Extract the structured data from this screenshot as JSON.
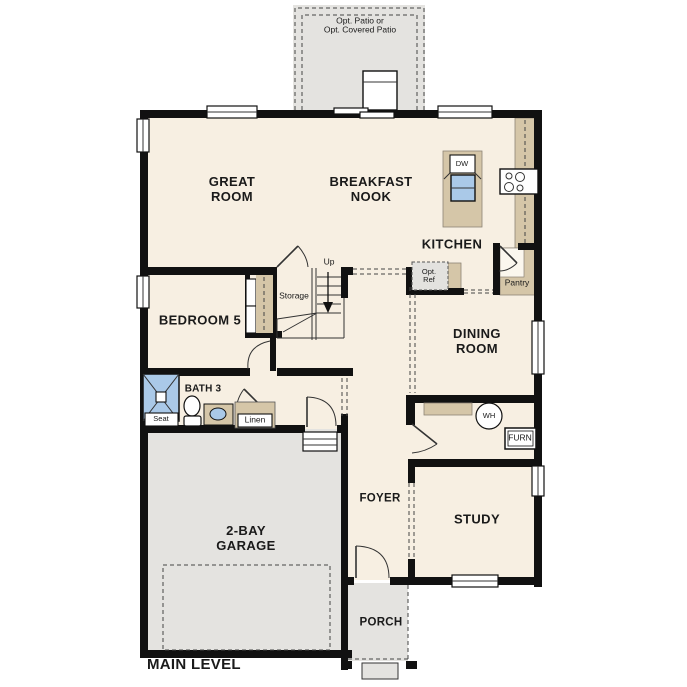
{
  "colors": {
    "wall": "#111111",
    "floor": "#f7efe2",
    "zone": "#e4e3e0",
    "counter": "#d5c6a8",
    "fixture": "#aac9e8",
    "optref": "#e3e2df"
  },
  "plan": {
    "title": "MAIN LEVEL",
    "patio_label": "Opt. Patio or\nOpt. Covered Patio",
    "rooms": {
      "great_room": "GREAT\nROOM",
      "breakfast_nook": "BREAKFAST\nNOOK",
      "kitchen": "KITCHEN",
      "bedroom5": "BEDROOM 5",
      "bath3": "BATH 3",
      "dining_room": "DINING\nROOM",
      "foyer": "FOYER",
      "study": "STUDY",
      "garage": "2-BAY\nGARAGE",
      "porch": "PORCH"
    },
    "fixtures": {
      "dw": "DW",
      "opt_ref": "Opt.\nRef",
      "pantry": "Pantry",
      "storage": "Storage",
      "up": "Up",
      "seat": "Seat",
      "linen": "Linen",
      "wh": "WH",
      "furn": "FURN"
    }
  }
}
